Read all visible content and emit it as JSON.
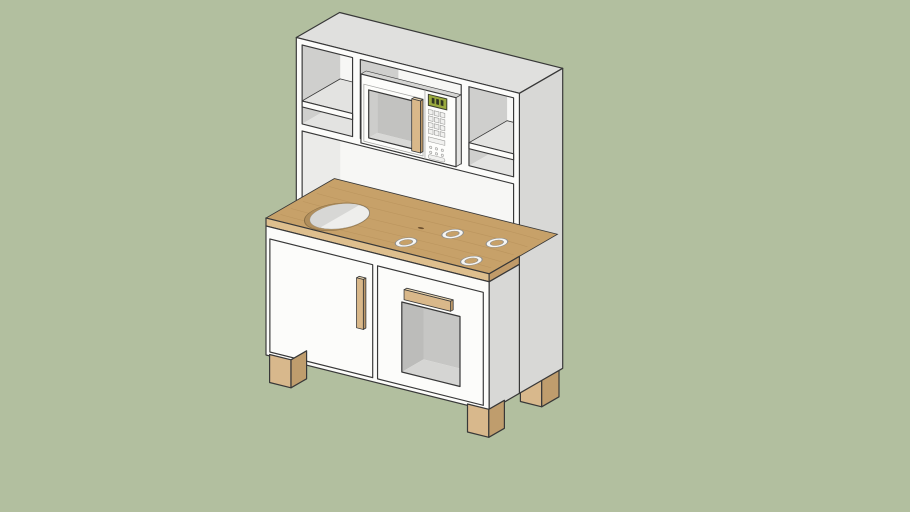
{
  "viewport": {
    "label": "Toy play kitchen 3D model",
    "background_note": "plain sage-green backdrop, no ground shadow"
  },
  "model": {
    "label": "play kitchen",
    "burner_count": 4,
    "parts": [
      "hutch with side shelf compartments",
      "built-in microwave with wooden handle and keypad",
      "green digital display",
      "wooden countertop with sink cutout",
      "four burner rings",
      "left cabinet door with vertical wooden handle",
      "oven door with window and horizontal wooden handle",
      "wooden block feet"
    ]
  },
  "colors": {
    "bg": "#b2bf9f",
    "edge": "#383838",
    "face-white": "#fcfcfa",
    "face-top": "#e0e0de",
    "face-side": "#d8d8d6",
    "back-panel": "#f7f7f5",
    "int-wall": "#cfcfcd",
    "int-floor": "#e3e3e1",
    "int-wall-light": "#ebebe9",
    "wood-top": "#c7a169",
    "wood-grain": "#ad8751",
    "wood-edge-front": "#debf8e",
    "wood-edge-end": "#c19b69",
    "wood-knot": "#6f5230",
    "sink-rim": "#b08e5c",
    "sink-inner": "#eeeeec",
    "sink-shade": "#d7d7d5",
    "burner-ring": "#f6f6f4",
    "burner-line": "#8f8f8d",
    "handle-front": "#d9b88a",
    "handle-side": "#bc9868",
    "handle-top": "#ead6b0",
    "foot-front": "#d8b88c",
    "foot-side": "#bf9d6d",
    "mw-body": "#fdfdfb",
    "mw-int-back": "#c2c2c0",
    "mw-int-wall": "#cdcdcb",
    "mw-int-floor": "#d8d8d6",
    "mw-sliver": "#d6d6d4",
    "display-frame": "#3a3d2e",
    "display-green": "#9aaa3e",
    "display-digit": "#2f3520",
    "btn-face": "#f1f1ef",
    "btn-line": "#9b9b99",
    "oven-int-back": "#c6c6c4",
    "oven-int-wall": "#bcbcba",
    "oven-int-floor": "#d5d5d3",
    "seam": "#a5a5a3"
  }
}
